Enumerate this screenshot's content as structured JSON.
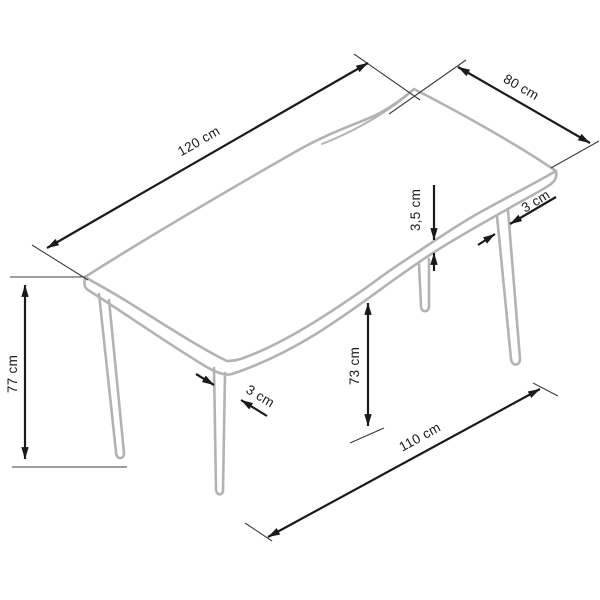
{
  "diagram": {
    "unit": "cm",
    "labels": {
      "length": "120 cm",
      "width": "80 cm",
      "top_thickness": "3,5 cm",
      "leg_thickness_back_right": "3 cm",
      "leg_thickness_front": "3 cm",
      "total_height": "77 cm",
      "underside_clearance": "73 cm",
      "leg_footprint_length": "110 cm"
    },
    "values_cm": {
      "length": 120,
      "width": 80,
      "top_thickness": 3.5,
      "leg_thickness": 3,
      "total_height": 77,
      "underside_clearance": 73,
      "leg_footprint_length": 110
    },
    "colors": {
      "dimension": "#1a1a1a",
      "furniture": "#b3b3b3",
      "extension": "#3d3d3d",
      "background": "#ffffff"
    }
  }
}
